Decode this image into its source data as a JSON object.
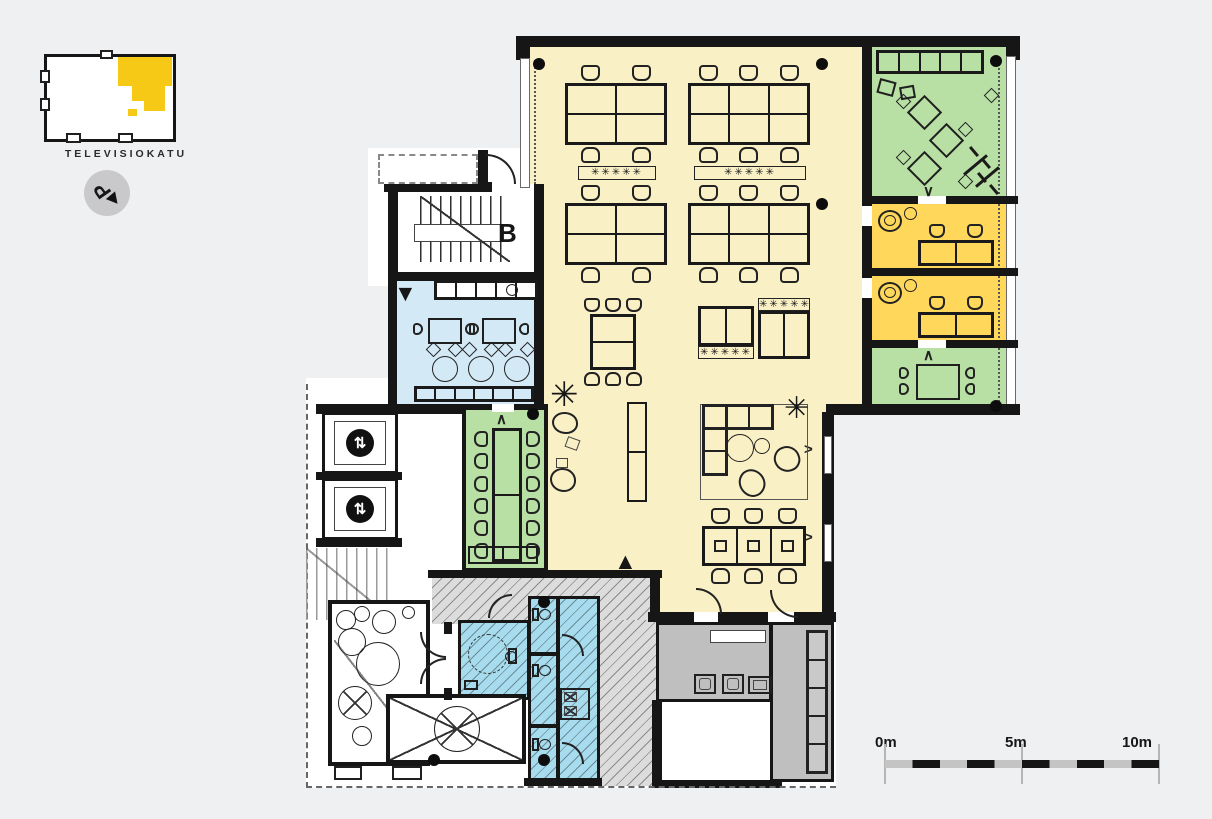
{
  "locator": {
    "street_label": "TELEVISIOKATU",
    "north_symbol": "P"
  },
  "plan": {
    "stair_label": "B",
    "markers": {
      "entry_down": "▼",
      "entry_up": "▲",
      "elevator": "⇅",
      "plant": "✳",
      "plants_row": "✳✳✳✳✳",
      "swing_up": "∧",
      "swing_down": "∨",
      "window_open": ">"
    }
  },
  "scalebar": {
    "labels": [
      "0m",
      "5m",
      "10m"
    ]
  },
  "colors": {
    "background": "#eff0f1",
    "open_office": "#FAF0C6",
    "private_office": "#FFD75A",
    "meeting_room": "#B8DFA4",
    "kitchen": "#D3E9F5",
    "wc": "#A7DCEF",
    "corridor": "#BFBFBF",
    "wall": "#161616",
    "highlight": "#F5C915",
    "hatch_fill": "#DCDCDC"
  }
}
